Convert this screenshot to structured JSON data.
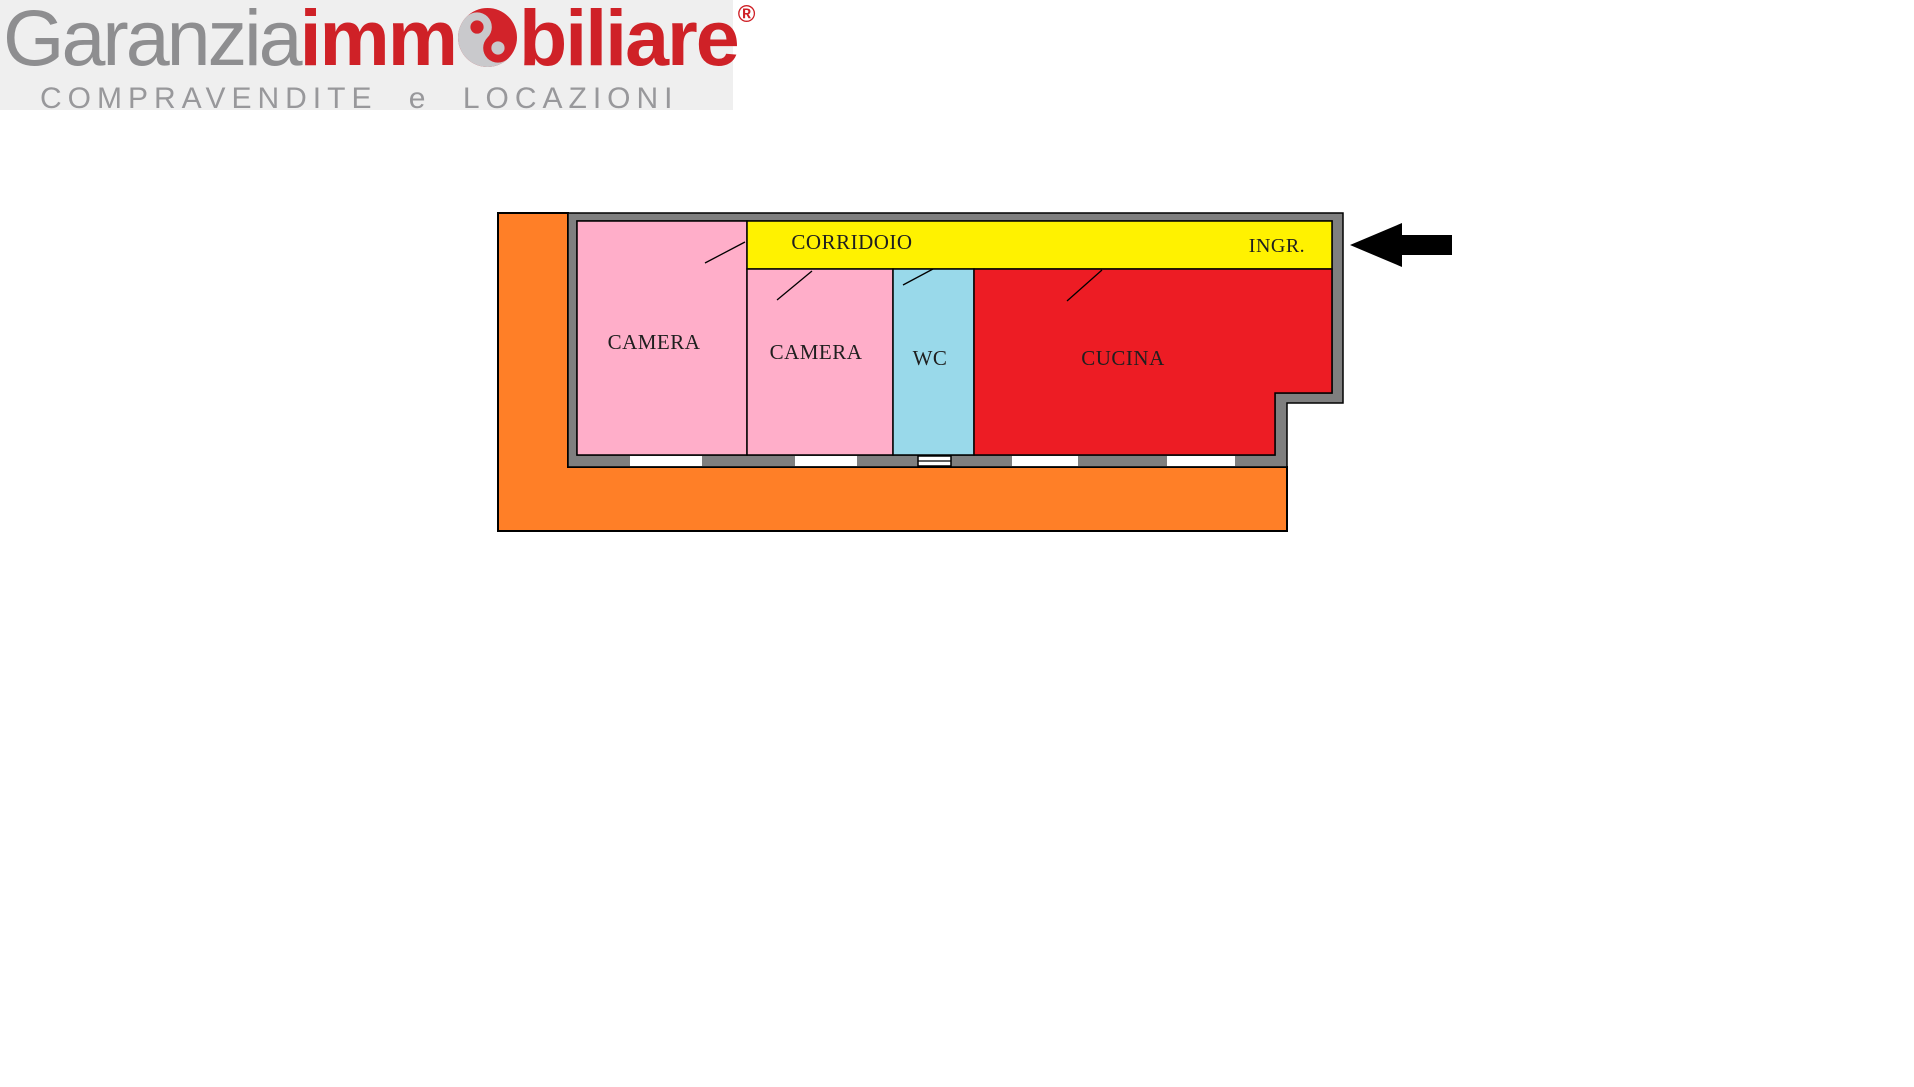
{
  "brand": {
    "logo_text": {
      "gray_part": "Garanzia",
      "red_part_1": "imm",
      "red_part_2": "biliare",
      "registered": "®"
    },
    "tagline": "COMPRAVENDITE e LOCAZIONI",
    "colors": {
      "text_gray": "#8e8e90",
      "text_red": "#cf2127",
      "tagline_gray": "#98989b",
      "panel_bg": "#efefef",
      "mark_red": "#d2232a",
      "mark_silver": "#c9c9cc"
    }
  },
  "floorplan": {
    "labels": {
      "camera1": "CAMERA",
      "camera2": "CAMERA",
      "wc": "WC",
      "cucina": "CUCINA",
      "corridoio": "CORRIDOIO",
      "ingresso": "INGR."
    },
    "colors": {
      "terrace": "#ff7f27",
      "wall": "#7f7f7f",
      "camera": "#ffaec9",
      "wc": "#99d9ea",
      "cucina": "#ed1c24",
      "corridoio": "#fff200",
      "window": "#ffffff",
      "outline": "#000000",
      "arrow": "#000000",
      "label_text": "#1f1f1f"
    }
  }
}
